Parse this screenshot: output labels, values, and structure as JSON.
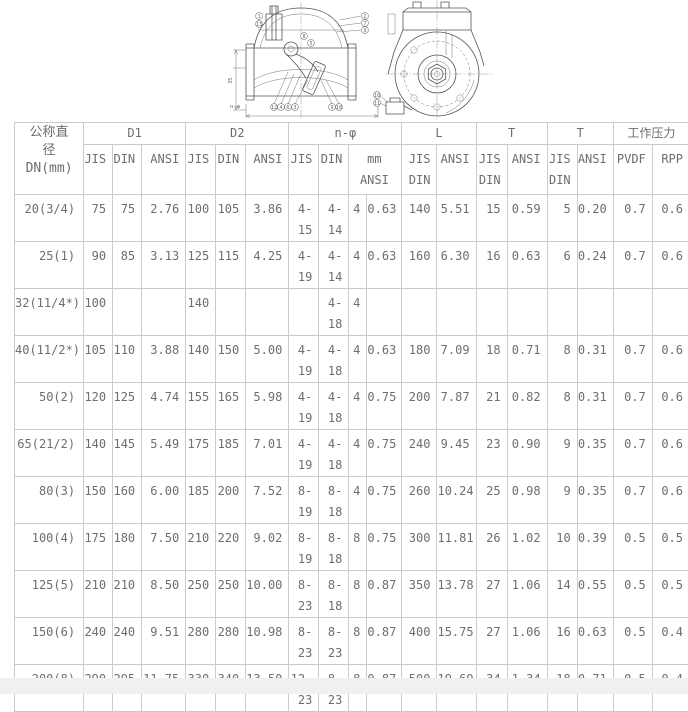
{
  "drawing": {
    "front_view_callouts": [
      "1",
      "13",
      "8",
      "5",
      "2",
      "7",
      "9",
      "12",
      "4",
      "6",
      "3",
      "9",
      "10"
    ],
    "side_view_callouts": [
      "10",
      "11"
    ],
    "bottom_dim_label": "n-φ"
  },
  "table": {
    "dn_header": "公称直\n径\nDN(mm)",
    "groups": [
      {
        "label": "D1"
      },
      {
        "label": "D2"
      },
      {
        "label": "n-φ"
      },
      {
        "label": "L"
      },
      {
        "label": "T"
      },
      {
        "label": "T"
      },
      {
        "label": "工作压力"
      }
    ],
    "subheaders": [
      "JIS",
      "DIN",
      "ANSI",
      "JIS",
      "DIN",
      "ANSI",
      "JIS",
      "DIN",
      "mm\nANSI",
      "JIS\nDIN",
      "ANSI",
      "JIS\nDIN",
      "ANSI",
      "JIS\nDIN",
      "ANSI",
      "PVDF",
      "RPP"
    ],
    "rows": [
      {
        "dn": "20(3/4)",
        "cells": [
          "75",
          "75",
          "2.76",
          "100",
          "105",
          "3.86",
          "4-\n15",
          "4-\n14",
          "4",
          "0.63",
          "140",
          "5.51",
          "15",
          "0.59",
          "5",
          "0.20",
          "0.7",
          "0.6"
        ]
      },
      {
        "dn": "25(1)",
        "cells": [
          "90",
          "85",
          "3.13",
          "125",
          "115",
          "4.25",
          "4-\n19",
          "4-\n14",
          "4",
          "0.63",
          "160",
          "6.30",
          "16",
          "0.63",
          "6",
          "0.24",
          "0.7",
          "0.6"
        ]
      },
      {
        "dn": "32(11/4*)",
        "cells": [
          "100",
          "",
          "",
          "140",
          "",
          "",
          "",
          "4-\n18",
          "4",
          "",
          "",
          "",
          "",
          "",
          "",
          "",
          "",
          ""
        ]
      },
      {
        "dn": "40(11/2*)",
        "cells": [
          "105",
          "110",
          "3.88",
          "140",
          "150",
          "5.00",
          "4-\n19",
          "4-\n18",
          "4",
          "0.63",
          "180",
          "7.09",
          "18",
          "0.71",
          "8",
          "0.31",
          "0.7",
          "0.6"
        ]
      },
      {
        "dn": "50(2)",
        "cells": [
          "120",
          "125",
          "4.74",
          "155",
          "165",
          "5.98",
          "4-\n19",
          "4-\n18",
          "4",
          "0.75",
          "200",
          "7.87",
          "21",
          "0.82",
          "8",
          "0.31",
          "0.7",
          "0.6"
        ]
      },
      {
        "dn": "65(21/2)",
        "cells": [
          "140",
          "145",
          "5.49",
          "175",
          "185",
          "7.01",
          "4-\n19",
          "4-\n18",
          "4",
          "0.75",
          "240",
          "9.45",
          "23",
          "0.90",
          "9",
          "0.35",
          "0.7",
          "0.6"
        ]
      },
      {
        "dn": "80(3)",
        "cells": [
          "150",
          "160",
          "6.00",
          "185",
          "200",
          "7.52",
          "8-\n19",
          "8-\n18",
          "4",
          "0.75",
          "260",
          "10.24",
          "25",
          "0.98",
          "9",
          "0.35",
          "0.7",
          "0.6"
        ]
      },
      {
        "dn": "100(4)",
        "cells": [
          "175",
          "180",
          "7.50",
          "210",
          "220",
          "9.02",
          "8-\n19",
          "8-\n18",
          "8",
          "0.75",
          "300",
          "11.81",
          "26",
          "1.02",
          "10",
          "0.39",
          "0.5",
          "0.5"
        ]
      },
      {
        "dn": "125(5)",
        "cells": [
          "210",
          "210",
          "8.50",
          "250",
          "250",
          "10.00",
          "8-\n23",
          "8-\n18",
          "8",
          "0.87",
          "350",
          "13.78",
          "27",
          "1.06",
          "14",
          "0.55",
          "0.5",
          "0.5"
        ]
      },
      {
        "dn": "150(6)",
        "cells": [
          "240",
          "240",
          "9.51",
          "280",
          "280",
          "10.98",
          "8-\n23",
          "8-\n23",
          "8",
          "0.87",
          "400",
          "15.75",
          "27",
          "1.06",
          "16",
          "0.63",
          "0.5",
          "0.4"
        ]
      },
      {
        "dn": "200(8)",
        "cells": [
          "290",
          "295",
          "11.75",
          "330",
          "340",
          "13.50",
          "12-\n23",
          "8-\n23",
          "8",
          "0.87",
          "500",
          "19.69",
          "34",
          "1.34",
          "18",
          "0.71",
          "0.5",
          "0.4"
        ]
      }
    ]
  }
}
